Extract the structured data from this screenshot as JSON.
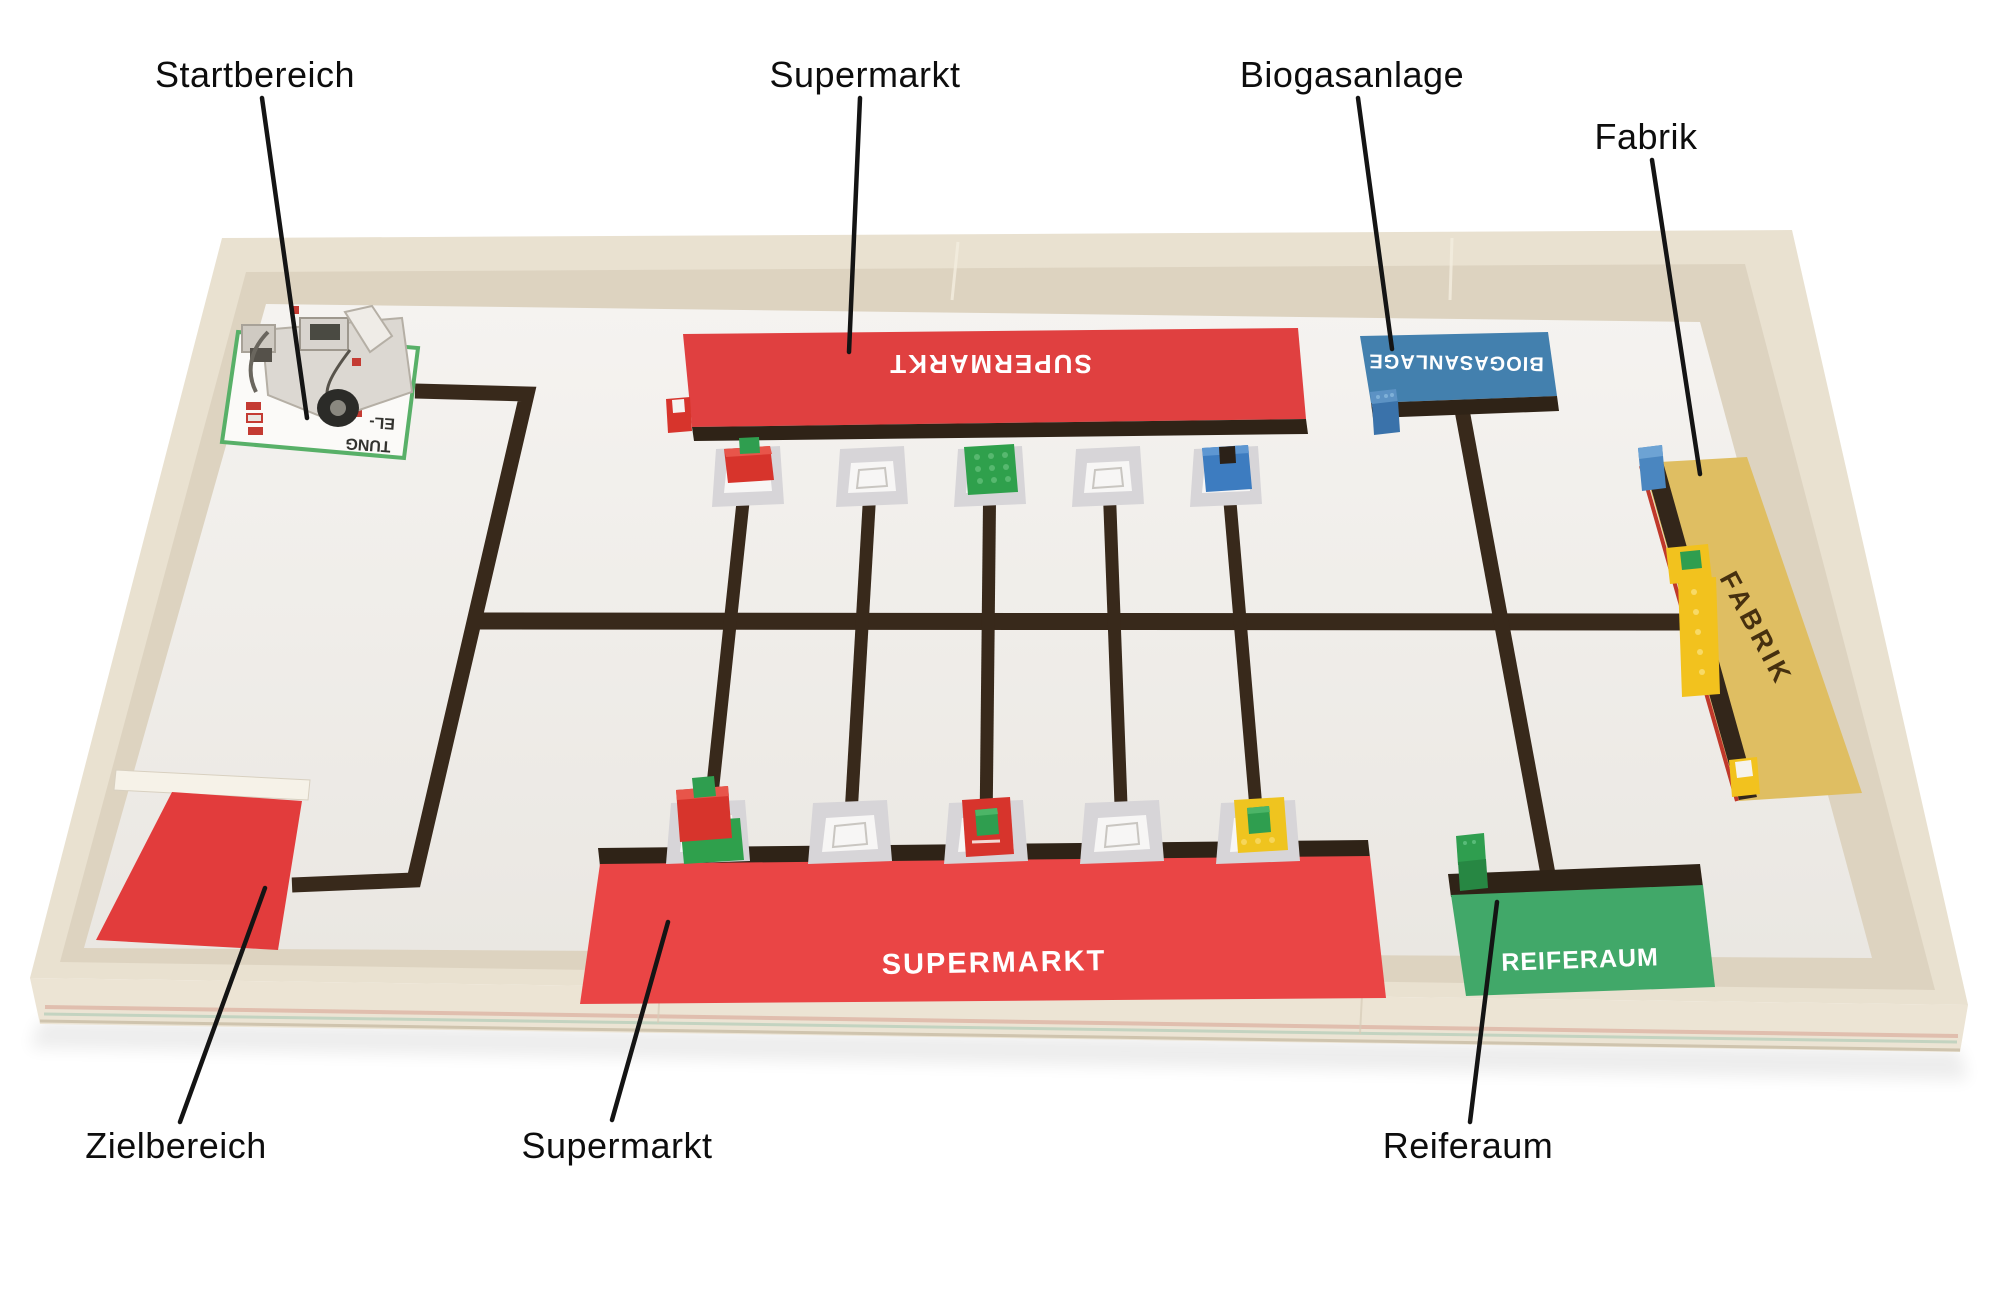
{
  "title": "Annotated robot competition field",
  "annotations": {
    "items": [
      {
        "id": "startbereich",
        "label": "Startbereich"
      },
      {
        "id": "supermarkt-top",
        "label": "Supermarkt"
      },
      {
        "id": "biogasanlage",
        "label": "Biogasanlage"
      },
      {
        "id": "fabrik",
        "label": "Fabrik"
      },
      {
        "id": "zielbereich",
        "label": "Zielbereich"
      },
      {
        "id": "supermarkt-bottom",
        "label": "Supermarkt"
      },
      {
        "id": "reiferaum",
        "label": "Reiferaum"
      }
    ]
  },
  "board": {
    "zones": {
      "supermarkt_top": {
        "label": "SUPERMARKT",
        "color": "#e04040",
        "text_color": "#ffffff",
        "orientation": "upside-down"
      },
      "supermarkt_bottom": {
        "label": "SUPERMARKT",
        "color": "#ea4545",
        "text_color": "#ffffff",
        "orientation": "normal"
      },
      "biogasanlage": {
        "label": "BIOGASANLAGE",
        "color": "#4380ae",
        "text_color": "#ffffff",
        "orientation": "upside-down"
      },
      "fabrik": {
        "label": "FABRIK",
        "color": "#dfbe62",
        "text_color": "#46300f",
        "orientation": "rotated"
      },
      "reiferaum": {
        "label": "REIFERAUM",
        "color": "#41a869",
        "text_color": "#ffffff",
        "orientation": "normal"
      },
      "zielbereich": {
        "color": "#e23c3c"
      },
      "startbereich": {
        "card_text_fragments": [
          "EL-",
          "TUNG"
        ]
      }
    },
    "road_color": "#38291b",
    "edge_strip_color": "#2f2317",
    "mat_color": "#f2f0ec",
    "frame_color": "#e9e1d0",
    "cargo_pallets": {
      "top_row": [
        "red-block-with-green-brick",
        "empty",
        "green-plate",
        "empty",
        "blue-block"
      ],
      "bottom_row": [
        "red-block-with-green-brick-on-green-plate",
        "empty",
        "red-plate-with-green-brick",
        "empty",
        "yellow-plate-with-green-brick"
      ]
    },
    "loose_bricks": [
      "red-brick-at-top-supermarkt-corner",
      "blue-brick-at-biogasanlage",
      "blue-piece-at-fabrik-top",
      "yellow-plate-with-green-brick-at-fabrik",
      "yellow-beam-at-fabrik-edge",
      "yellow-brick-with-white-tile-at-fabrik-bottom",
      "green-brick-stack-at-reiferaum",
      "white-beam-at-zielbereich-edge"
    ],
    "robot": {
      "description": "LEGO EV3 robot on start card"
    }
  }
}
